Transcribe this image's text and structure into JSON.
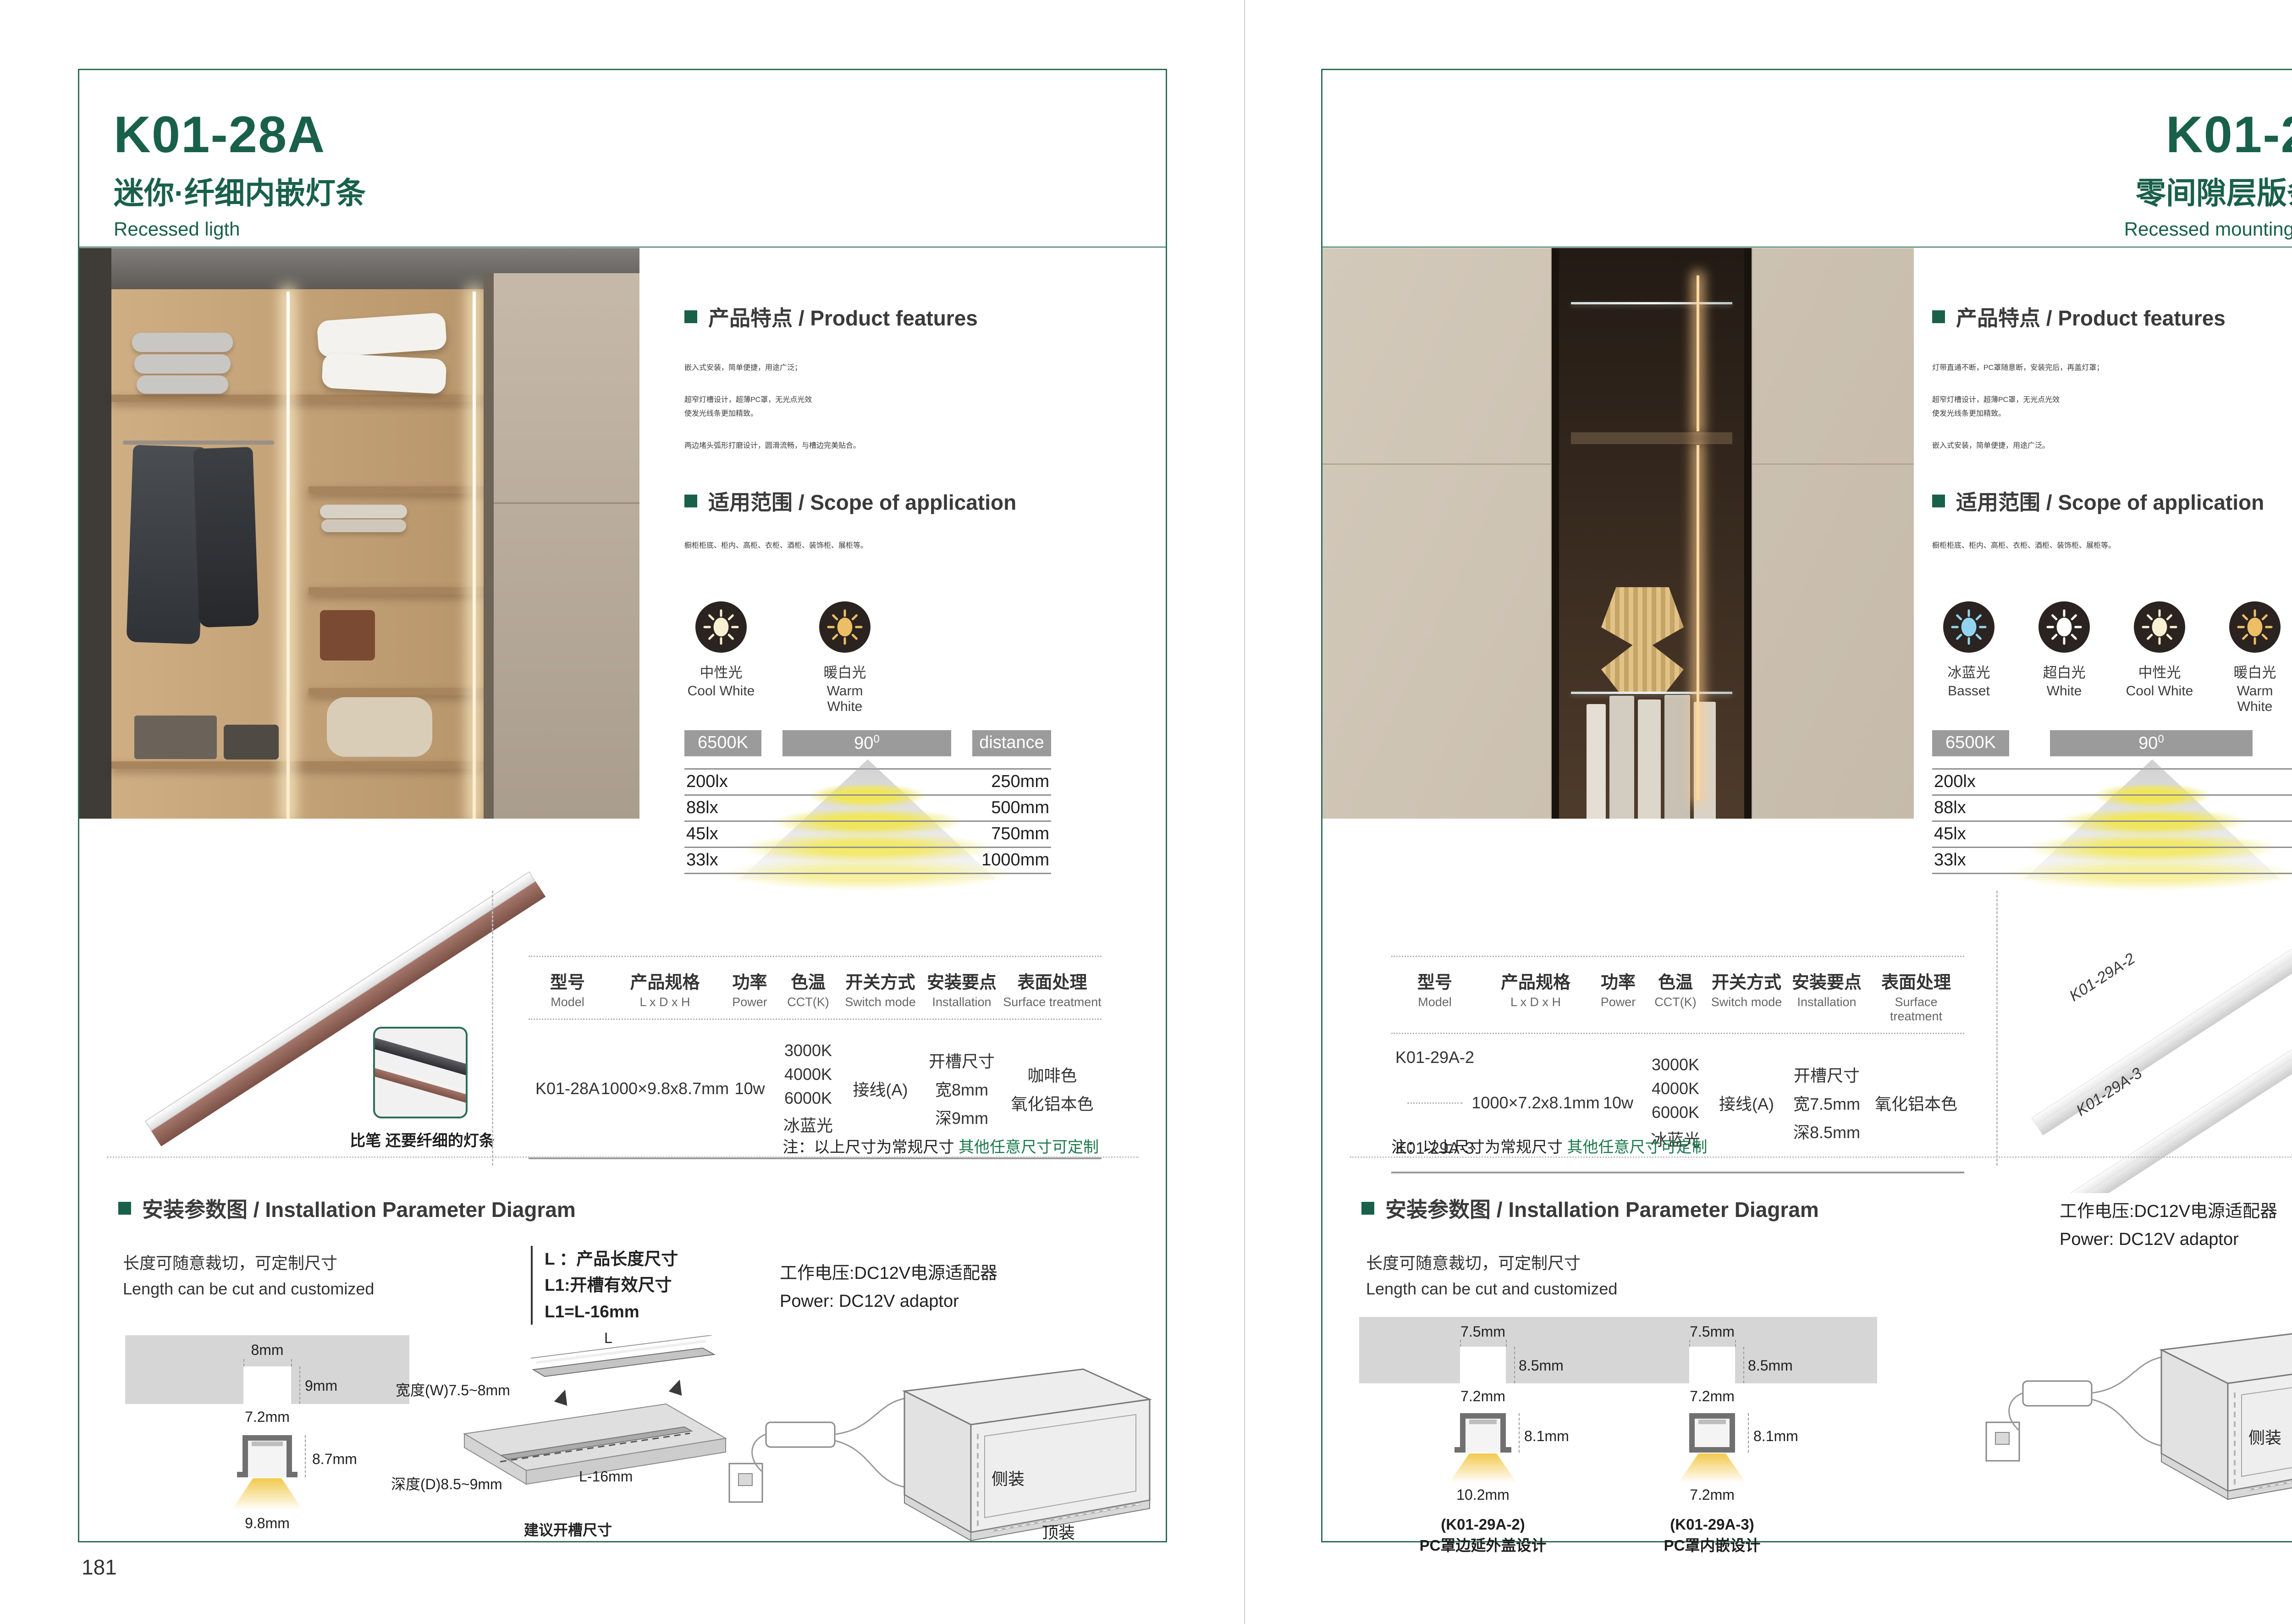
{
  "common": {
    "section_features": "产品特点 / Product features",
    "section_scope": "适用范围 / Scope of application",
    "section_install": "安装参数图 / Installation Parameter Diagram",
    "cut_cn": "长度可随意裁切，可定制尺寸",
    "cut_en": "Length can be cut and customized",
    "power_cn": "工作电压:DC12V电源适配器",
    "power_en": "Power: DC12V adaptor",
    "note_black": "注：以上尺寸为常规尺寸",
    "note_green": "其他任意尺寸可定制",
    "mount_side": "侧装",
    "mount_top": "顶装",
    "colors": {
      "brand_green": "#19604a",
      "note_green": "#1c7a4d",
      "bar_gray": "#9b9b9b"
    }
  },
  "photometric": {
    "cct": "6500K",
    "angle": "90",
    "angle_sup": "0",
    "distance_label": "distance",
    "rows": [
      {
        "lx": "200lx",
        "mm": "250mm"
      },
      {
        "lx": "88lx",
        "mm": "500mm"
      },
      {
        "lx": "45lx",
        "mm": "750mm"
      },
      {
        "lx": "33lx",
        "mm": "1000mm"
      }
    ]
  },
  "spec_headers": [
    {
      "cn": "型号",
      "en": "Model"
    },
    {
      "cn": "产品规格",
      "en": "L x D x H"
    },
    {
      "cn": "功率",
      "en": "Power"
    },
    {
      "cn": "色温",
      "en": "CCT(K)"
    },
    {
      "cn": "开关方式",
      "en": "Switch mode"
    },
    {
      "cn": "安装要点",
      "en": "Installation"
    },
    {
      "cn": "表面处理",
      "en": "Surface treatment"
    }
  ],
  "left": {
    "page_no": "181",
    "model": "K01-28A",
    "subtitle_cn": "迷你·纤细内嵌灯条",
    "subtitle_en": "Recessed ligth",
    "features": [
      "嵌入式安装，简单便捷，用途广泛；",
      "超窄灯槽设计，超薄PC罩，无光点光效",
      "使发光线条更加精致。",
      "两边堵头弧形打磨设计，圆滑流畅，与槽边完美贴合。"
    ],
    "scope": "橱柜柜底、柜内、高柜、衣柜、酒柜、装饰柜、展柜等。",
    "icons": [
      {
        "cn": "中性光",
        "en": "Cool White",
        "color": "#f8f0d0"
      },
      {
        "cn": "暖白光",
        "en": "Warm White",
        "color": "#ecbe66"
      }
    ],
    "product_caption": "比笔 还要纤细的灯条",
    "table": {
      "model": "K01-28A",
      "size": "1000×9.8x8.7mm",
      "power": "10w",
      "cct": [
        "3000K",
        "4000K",
        "6000K",
        "冰蓝光"
      ],
      "switch": "接线(A)",
      "install": [
        "开槽尺寸",
        "宽8mm",
        "深9mm"
      ],
      "surface": [
        "咖啡色",
        "氧化铝本色"
      ]
    },
    "legend": [
      "L ：产品长度尺寸",
      "L1:开槽有效尺寸",
      "L1=L-16mm"
    ],
    "iso": {
      "w": "宽度(W)7.5~8mm",
      "d": "深度(D)8.5~9mm",
      "len": "L",
      "len16": "L-16mm",
      "caption": "建议开槽尺寸"
    },
    "dims": {
      "slot_w": "8mm",
      "slot_d": "9mm",
      "body_w": "7.2mm",
      "body_h": "8.7mm",
      "flange_w": "9.8mm"
    }
  },
  "right": {
    "page_no": "182",
    "model": "K01-29A",
    "subtitle_cn": "零间隙层版条形灯",
    "subtitle_en": "Recessed mounting LED light",
    "features": [
      "灯带直通不断，PC罩随意断，安装完后，再盖灯罩；",
      "超窄灯槽设计，超薄PC罩，无光点光效",
      "使发光线条更加精致。",
      "嵌入式安装，简单便捷，用途广泛。"
    ],
    "scope": "橱柜柜底、柜内、高柜、衣柜、酒柜、装饰柜、展柜等。",
    "icons": [
      {
        "cn": "冰蓝光",
        "en": "Basset",
        "color": "#92d4ef"
      },
      {
        "cn": "超白光",
        "en": "White",
        "color": "#ffffff"
      },
      {
        "cn": "中性光",
        "en": "Cool White",
        "color": "#f8f0d0"
      },
      {
        "cn": "暖白光",
        "en": "Warm White",
        "color": "#ecbe66"
      }
    ],
    "product_labels": [
      "K01-29A-2",
      "K01-29A-3"
    ],
    "table": {
      "models": [
        "K01-29A-2",
        "K01-29A-3"
      ],
      "size": "1000×7.2x8.1mm",
      "power": "10w",
      "cct": [
        "3000K",
        "4000K",
        "6000K",
        "冰蓝光"
      ],
      "switch": "接线(A)",
      "install": [
        "开槽尺寸",
        "宽7.5mm",
        "深8.5mm"
      ],
      "surface": [
        "氧化铝本色"
      ]
    },
    "sections": [
      {
        "slot_w": "7.5mm",
        "slot_d": "8.5mm",
        "body_w": "7.2mm",
        "body_h": "8.1mm",
        "bottom": "10.2mm",
        "model": "(K01-29A-2)",
        "desc": "PC罩边延外盖设计"
      },
      {
        "slot_w": "7.5mm",
        "slot_d": "8.5mm",
        "body_w": "7.2mm",
        "body_h": "8.1mm",
        "bottom": "7.2mm",
        "model": "(K01-29A-3)",
        "desc": "PC罩内嵌设计"
      }
    ]
  }
}
